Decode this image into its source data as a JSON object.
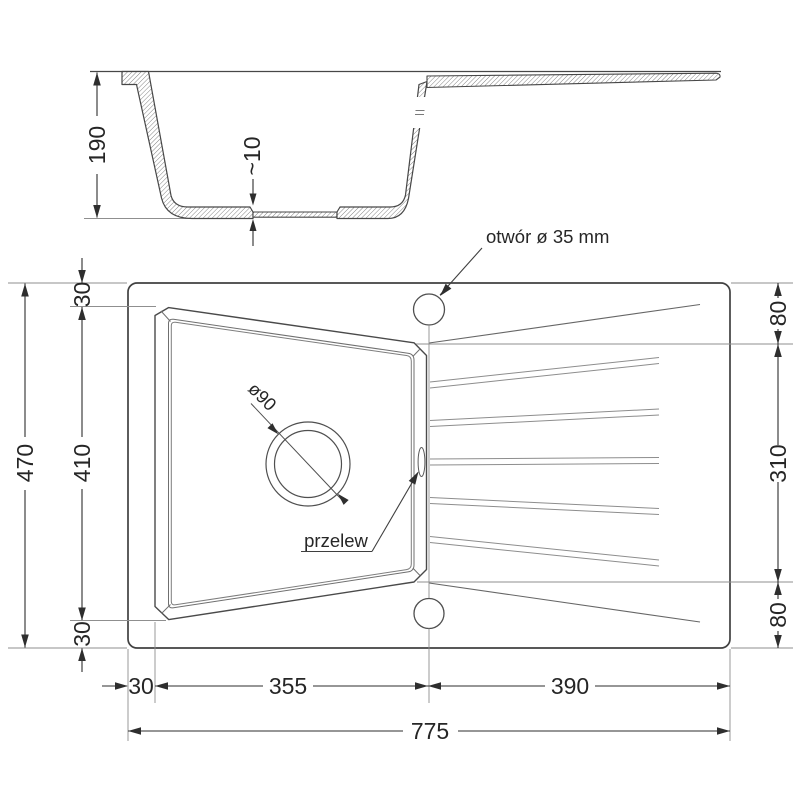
{
  "section_view": {
    "height": "190",
    "bottom_step": "~10"
  },
  "plan_view": {
    "hole_note": "otwór ø 35 mm",
    "drain_diameter": "ø90",
    "overflow_label": "przelew"
  },
  "dimensions": {
    "left": {
      "top_rim": "30",
      "bowl_length": "410",
      "bottom_rim": "30",
      "total_depth": "470"
    },
    "right": {
      "top_offset": "80",
      "drainer_span": "310",
      "bottom_offset": "80"
    },
    "bottom": {
      "left_rim": "30",
      "bowl_width": "355",
      "drainer_width": "390",
      "total_width": "775"
    }
  },
  "colors": {
    "line_dark": "#414141",
    "line_mid": "#6f6f6f",
    "line_light": "#8d8d8d",
    "dim_line": "#2e2e2e",
    "hatch": "#707070"
  }
}
